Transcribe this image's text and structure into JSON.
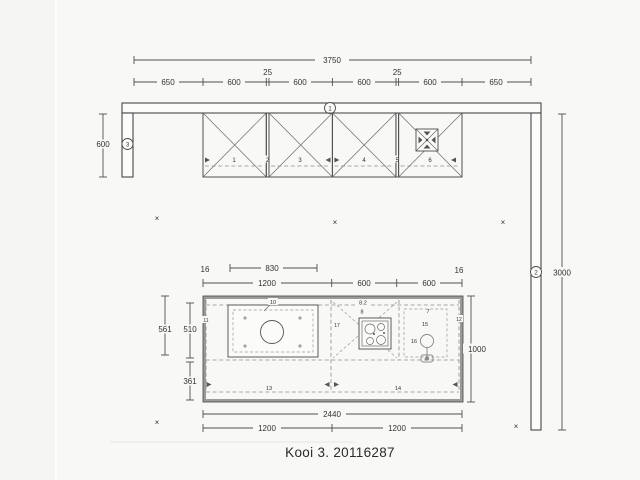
{
  "page": {
    "title": "Kooi 3. 20116287"
  },
  "markers": {
    "wall_top": "1",
    "wall_right": "2",
    "wall_left": "3",
    "cross": "×"
  },
  "dims": {
    "top_total": "3750",
    "top_segments": [
      "650",
      "600",
      "600",
      "600",
      "600",
      "650"
    ],
    "top_fillers": [
      "25",
      "25"
    ],
    "left_wall": "600",
    "right_wall": "3000",
    "island": {
      "overhang_left": "16",
      "overhang_right": "16",
      "table": "830",
      "top_row": [
        "1200",
        "600",
        "600"
      ],
      "left_outer": "561",
      "left_upper": "510",
      "left_lower": "361",
      "right": "1000",
      "bottom_total": "2440",
      "bottom_row": [
        "1200",
        "1200"
      ]
    }
  },
  "units": {
    "wall": [
      "1",
      "2",
      "3",
      "4",
      "5",
      "6"
    ],
    "island": {
      "u7": "7",
      "u8": "8",
      "u8_2": "8.2",
      "u10": "10",
      "u11": "11",
      "u12": "12",
      "u13": "13",
      "u14": "14",
      "u15": "15",
      "u16": "16",
      "u17": "17"
    }
  }
}
